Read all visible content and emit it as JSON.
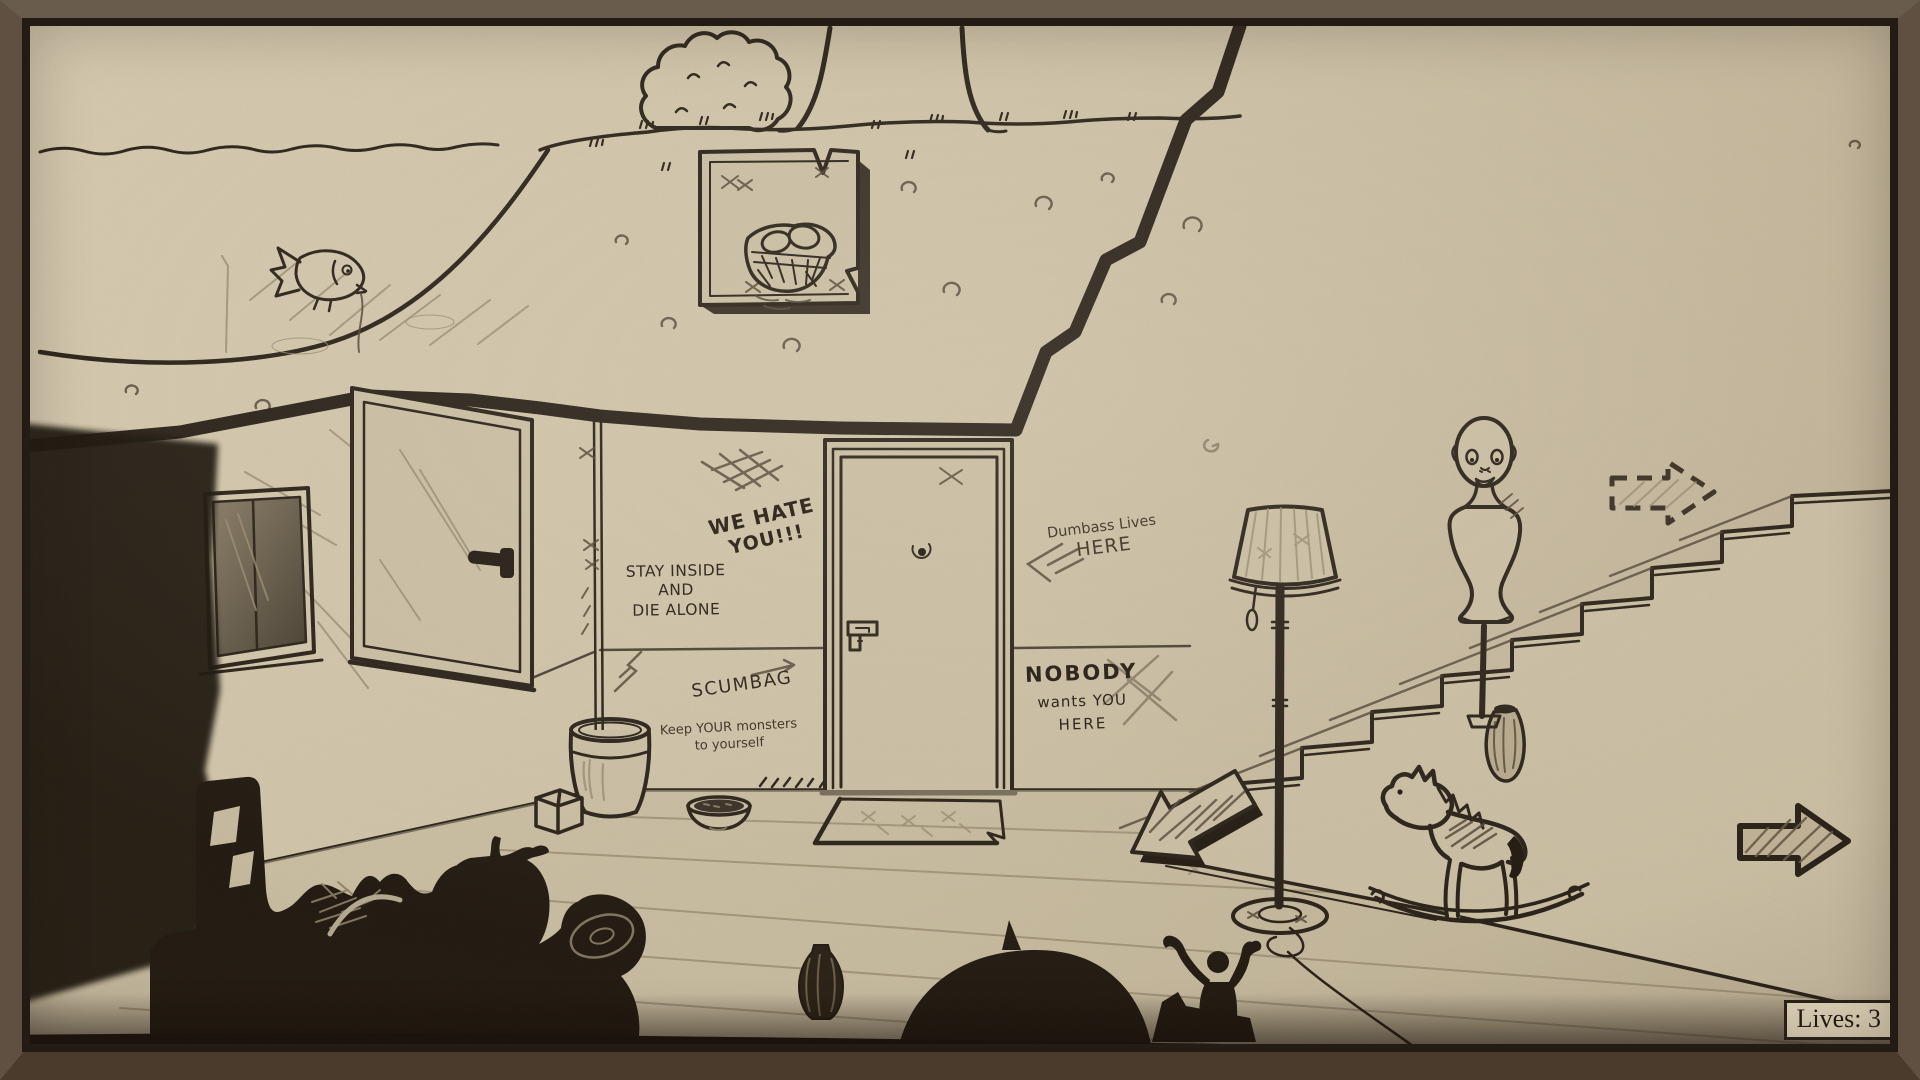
{
  "meta": {
    "app": "hand-drawn point-and-click adventure scene",
    "view": "basement room with outdoor cross-section above"
  },
  "palette": {
    "paper": "#d0c4a9",
    "ink": "#2b221a",
    "pencil": "#57493a",
    "silhouette": "#231a12",
    "frame": "#5f5041",
    "badge_bg": "#d9cdb2"
  },
  "hud": {
    "lives": "Lives: 3"
  },
  "graffiti": {
    "we_hate_you": {
      "line1": "WE HATE",
      "line2": "YOU!!!"
    },
    "stay_inside": {
      "line1": "STAY INSIDE",
      "line2": "AND",
      "line3": "DIE ALONE"
    },
    "dumbass": {
      "line1": "Dumbass Lives",
      "line2": "HERE"
    },
    "scumbag": {
      "text": "SCUMBAG"
    },
    "keep_monsters": {
      "line1": "Keep YOUR monsters",
      "line2": "to yourself"
    },
    "nobody": {
      "line1": "NOBODY",
      "line2": "wants YOU",
      "line3": "HERE"
    }
  },
  "icons": {
    "nav_right_arrow": "right-arrow-solid",
    "nav_dashed_arrow": "right-arrow-dashed",
    "stairs_arrow": "down-left-3d-arrow"
  },
  "scene_objects": [
    "pond-with-fish",
    "buried-nest-box-with-eggs",
    "bush",
    "tree-trunk",
    "left-door",
    "window",
    "center-door-with-peephole-and-lock",
    "bucket",
    "cube-box",
    "pet-bowl",
    "doormat",
    "wall-crack",
    "staircase",
    "floor-lamp",
    "dress-form-mannequin-with-doll-head",
    "vase-on-stairs",
    "rocking-horse",
    "floor-vase",
    "chair-silhouette",
    "junk-pile-silhouette",
    "tuba-silhouette",
    "dome-silhouette",
    "cheering-figure-silhouette",
    "cast-shadow"
  ]
}
